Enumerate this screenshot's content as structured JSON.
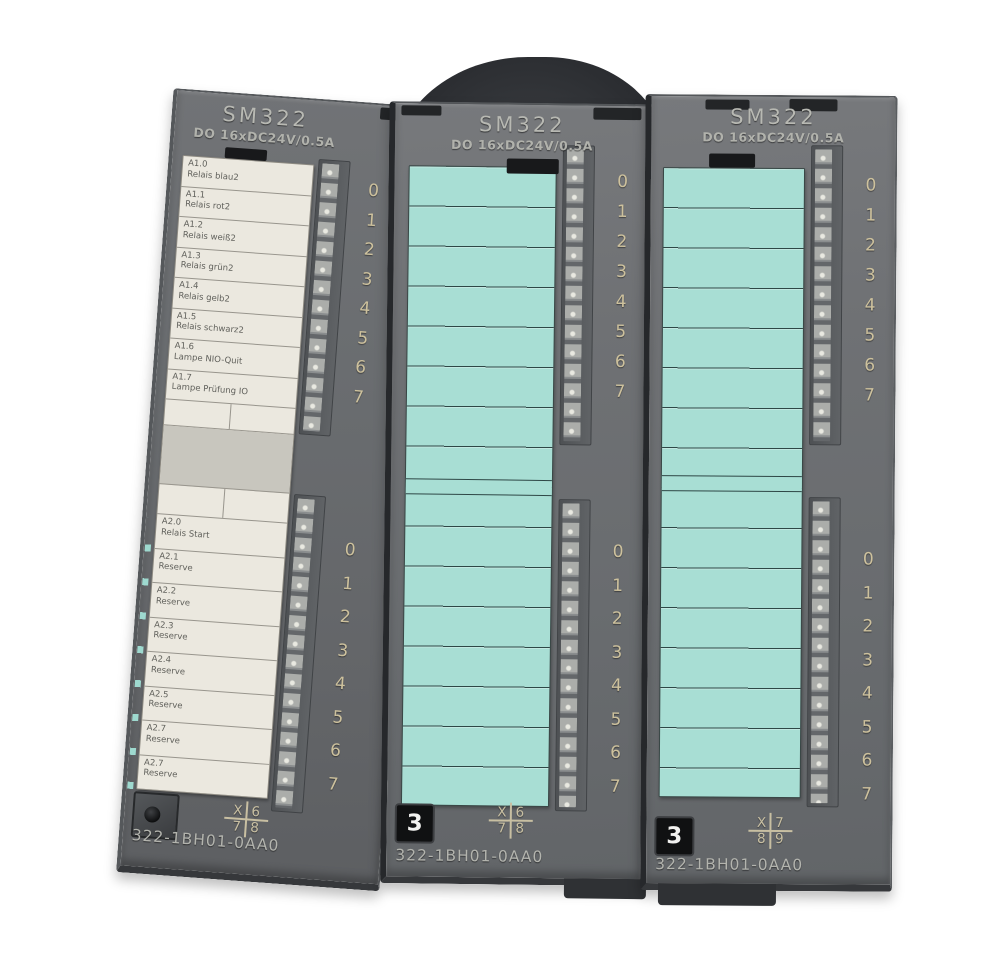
{
  "led_digits": [
    "0",
    "1",
    "2",
    "3",
    "4",
    "5",
    "6",
    "7"
  ],
  "colors": {
    "module_body": "#6e7174",
    "label_strip_white": "#ebe8df",
    "label_strip_teal": "#a8ded4",
    "digit_print": "#cdc19d",
    "slot_badge_bg": "#101112",
    "slot_badge_text": "#f2f2f0",
    "background": "#ffffff"
  },
  "modules": [
    {
      "title": "SM322",
      "subtitle": "DO 16xDC24V/0.5A",
      "part_number": "322-1BH01-0AA0",
      "terminal_map": {
        "tl": "X",
        "tr": "6",
        "bl": "7",
        "br": "8"
      },
      "labels_upper": [
        {
          "code": "A1.0",
          "desc": "Relais blau2"
        },
        {
          "code": "A1.1",
          "desc": "Relais rot2"
        },
        {
          "code": "A1.2",
          "desc": "Relais weiß2"
        },
        {
          "code": "A1.3",
          "desc": "Relais grün2"
        },
        {
          "code": "A1.4",
          "desc": "Relais gelb2"
        },
        {
          "code": "A1.5",
          "desc": "Relais schwarz2"
        },
        {
          "code": "A1.6",
          "desc": "Lampe NIO-Quit"
        },
        {
          "code": "A1.7",
          "desc": "Lampe Prüfung IO"
        }
      ],
      "labels_lower": [
        {
          "code": "A2.0",
          "desc": "Relais Start"
        },
        {
          "code": "A2.1",
          "desc": "Reserve"
        },
        {
          "code": "A2.2",
          "desc": "Reserve"
        },
        {
          "code": "A2.3",
          "desc": "Reserve"
        },
        {
          "code": "A2.4",
          "desc": "Reserve"
        },
        {
          "code": "A2.5",
          "desc": "Reserve"
        },
        {
          "code": "A2.7",
          "desc": "Reserve"
        },
        {
          "code": "A2.7",
          "desc": "Reserve"
        }
      ]
    },
    {
      "title": "SM322",
      "subtitle": "DO 16xDC24V/0.5A",
      "part_number": "322-1BH01-0AA0",
      "slot": "3",
      "terminal_map": {
        "tl": "X",
        "tr": "6",
        "bl": "7",
        "br": "8"
      }
    },
    {
      "title": "SM322",
      "subtitle": "DO 16xDC24V/0.5A",
      "part_number": "322-1BH01-0AA0",
      "slot": "3",
      "terminal_map": {
        "tl": "X",
        "tr": "7",
        "bl": "8",
        "br": "9"
      }
    }
  ]
}
